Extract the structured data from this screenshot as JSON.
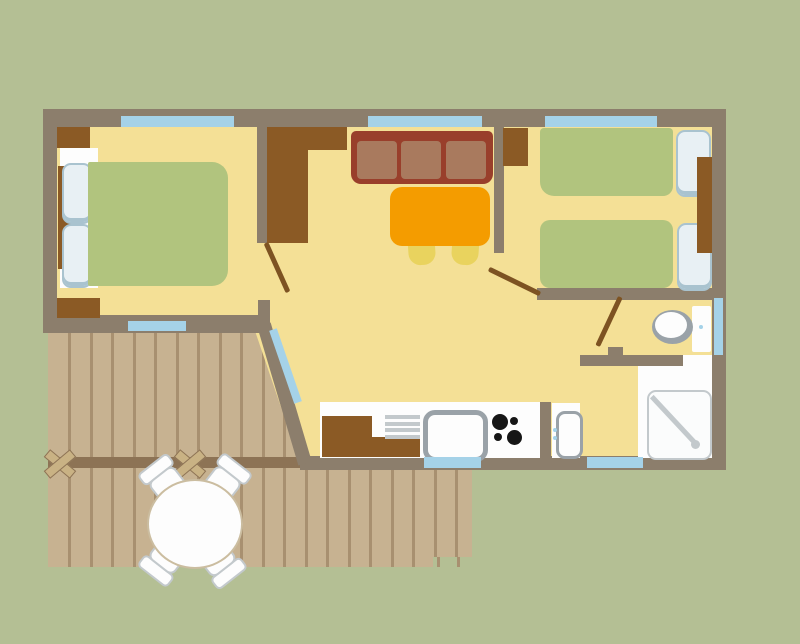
{
  "title": "Mobile-home floor plan with terrace (top-down view, no text labels)",
  "colors": {
    "bg": "#b4bf94",
    "wall": "#8c7e6c",
    "floor": "#f4e096",
    "deck": "#c7b291",
    "plank": "#a89070",
    "rail": "#8d7355",
    "xmark": "#c9b284",
    "window": "#a5d2e8",
    "wood": "#8b5a25",
    "door": "#7d5322",
    "bed": "#b1c47e",
    "pillow": "#e8f0f4",
    "pillow_border": "#a9c3cf",
    "sofa_frame": "#993f2b",
    "sofa_cushion": "#a97a5e",
    "table": "#f49c00",
    "chair": "#e9d35e",
    "white": "#fdfdfd",
    "gray": "#9aa2a8",
    "gray_light": "#c3c9cc",
    "burner": "#161616",
    "outline_tan": "#cbbda0"
  },
  "rooms": [
    {
      "name": "double-bedroom",
      "furniture": [
        "double-bed",
        "two-pillows",
        "headboard",
        "corner-cabinet-top",
        "corner-cabinet-bottom",
        "window-top",
        "window-bottom",
        "door"
      ]
    },
    {
      "name": "living-dining-room",
      "furniture": [
        "wardrobe",
        "cabinet",
        "three-seat-sofa",
        "dining-table",
        "two-chairs",
        "window-top",
        "glazed-terrace-door"
      ]
    },
    {
      "name": "twin-bedroom",
      "furniture": [
        "twin-bed-1",
        "twin-bed-2",
        "pillows",
        "nightstand",
        "cabinet",
        "window-top",
        "door"
      ]
    },
    {
      "name": "kitchen",
      "furniture": [
        "counter",
        "base-cabinet",
        "drainboard",
        "sink",
        "four-burner-hob",
        "window-bottom"
      ]
    },
    {
      "name": "bathroom",
      "furniture": [
        "toilet",
        "shower-tray",
        "washbasin",
        "window-right",
        "window-bottom",
        "door"
      ]
    },
    {
      "name": "terrace",
      "furniture": [
        "wood-decking",
        "railing-beam",
        "two-cross-braces",
        "round-table",
        "four-chairs",
        "step"
      ]
    }
  ]
}
